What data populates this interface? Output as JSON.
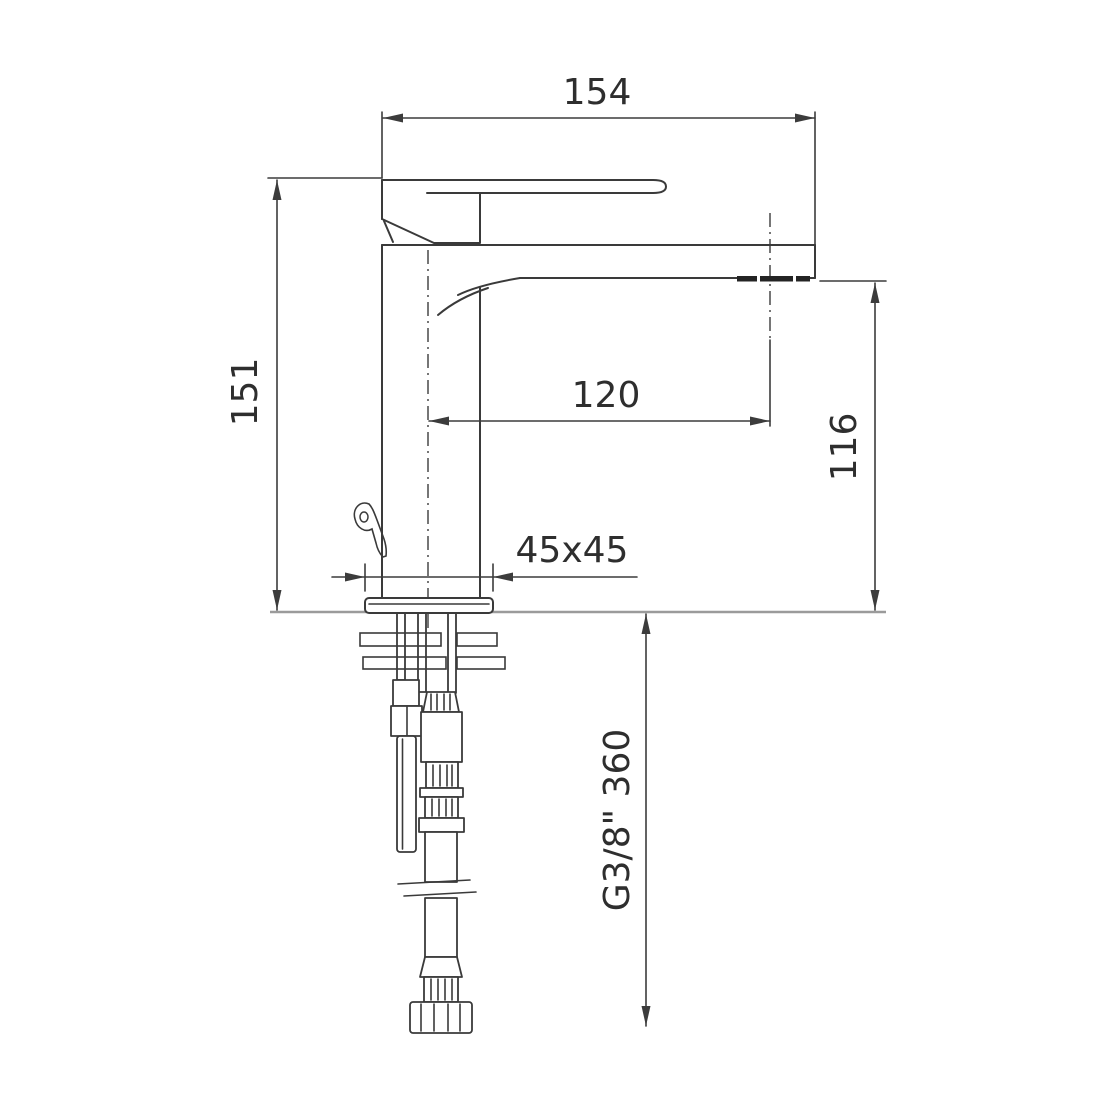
{
  "drawing": {
    "subject": "Basin mixer faucet technical drawing, side elevation with installation dimensions",
    "background_color": "#ffffff",
    "line_color": "#3a3a3a",
    "counter_line_color": "#9b9b9b",
    "text_color": "#2e2e2e",
    "dimensions": {
      "overall_depth": "154",
      "body_height": "151",
      "spout_reach": "120",
      "spout_height": "116",
      "base_footprint": "45x45",
      "hose_spec": "G3/8\" 360"
    }
  }
}
